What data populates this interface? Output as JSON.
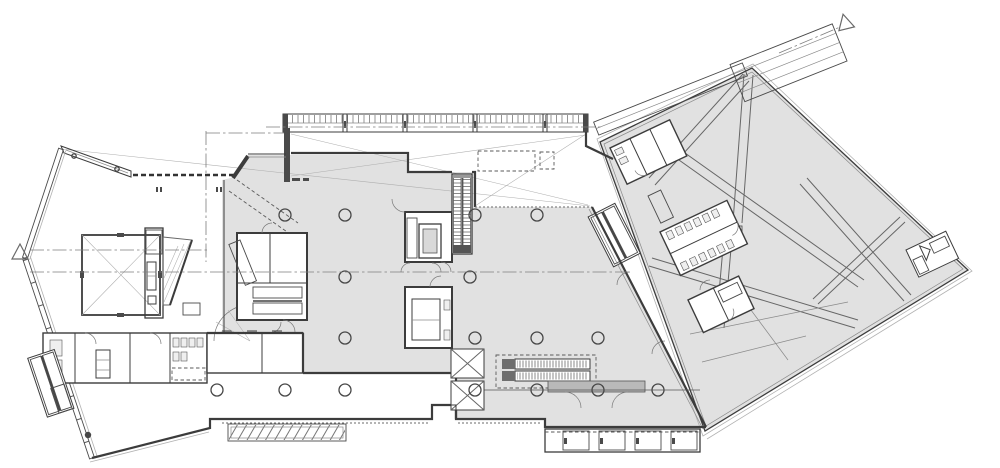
{
  "drawing": {
    "kind": "architectural-floor-plan",
    "level": "ground-floor",
    "text_labels": []
  },
  "palette": {
    "background": "#ffffff",
    "floor_fill": "#e1e1e1",
    "floor_fill_light": "#e9e9e9",
    "wall_dark": "#3c3c3c",
    "line_mid": "#666666",
    "line_light": "#b2b2b2",
    "hatch": "#555555",
    "entrance_mat": "#b9b9b9"
  },
  "markers": {
    "section_left": {
      "x": 20,
      "y": 252,
      "rotation": 0
    },
    "section_topright": {
      "x": 845,
      "y": 22,
      "rotation": -14
    }
  },
  "columns": {
    "radius": 6,
    "points": [
      [
        285,
        215
      ],
      [
        345,
        215
      ],
      [
        475,
        215
      ],
      [
        537,
        215
      ],
      [
        345,
        277
      ],
      [
        470,
        277
      ],
      [
        345,
        338
      ],
      [
        475,
        338
      ],
      [
        537,
        338
      ],
      [
        598,
        338
      ],
      [
        217,
        390
      ],
      [
        285,
        390
      ],
      [
        345,
        390
      ],
      [
        475,
        390
      ],
      [
        537,
        390
      ],
      [
        598,
        390
      ],
      [
        658,
        390
      ]
    ],
    "solid_dots": [
      [
        88,
        435
      ]
    ]
  },
  "stairs": {
    "exterior_bottom_flights": 4,
    "upper_escalator_bands": 2,
    "lower_escalator_bands": 2
  },
  "icons": {
    "section_marker": "open-triangle",
    "column": "open-circle",
    "door_swing": "quarter-arc",
    "revolving_door": "x-blades-in-frame"
  }
}
